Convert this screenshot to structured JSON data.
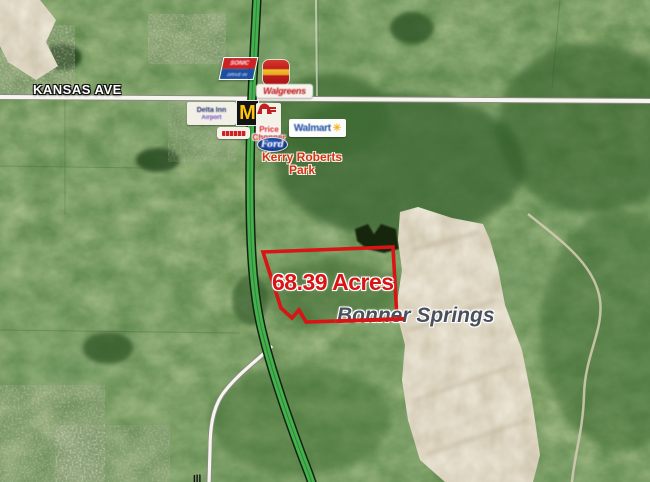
{
  "map": {
    "city_label": "Bonner Springs",
    "parcel": {
      "acreage_label": "68.39 Acres",
      "outline_color": "#d81414",
      "points": "263,252 393,247 397,319 306,322 299,310 292,318 281,308"
    },
    "roads": {
      "kansas_ave_label": "KANSAS AVE",
      "highway_shield": "7",
      "clipped_road_label": "Ill"
    },
    "park_label": {
      "line1": "Kerry Roberts",
      "line2": "Park"
    },
    "businesses": {
      "sonic": {
        "line1": "SONIC",
        "line2": "DRIVE-IN"
      },
      "walgreens": "Walgreens",
      "hotel": {
        "line1": "Delta Inn",
        "line2": "Airport"
      },
      "mcdonalds": "M",
      "price_chopper": {
        "line1": "Price",
        "line2": "Chopper"
      },
      "walmart": {
        "name": "Walmart",
        "spark": "✳"
      },
      "ford": "Ford"
    },
    "colors": {
      "annotation_red": "#d81414",
      "highway_green": "#44b04e",
      "city_text_gray": "#4a505c",
      "quarry_tan": "#cbc1a8"
    }
  }
}
